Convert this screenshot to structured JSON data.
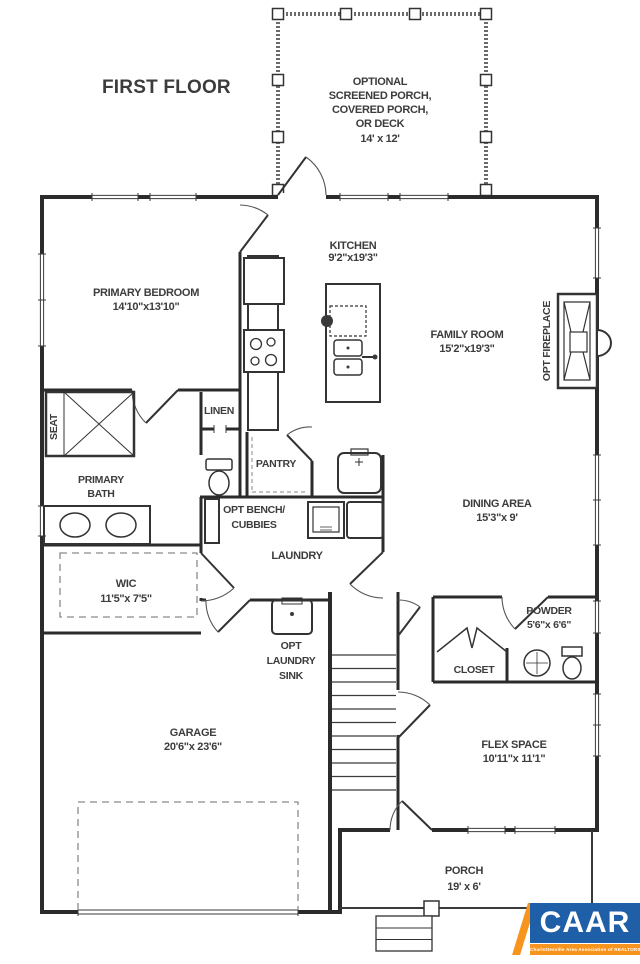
{
  "title": "FIRST FLOOR",
  "rooms": {
    "optional_porch": {
      "line1": "OPTIONAL",
      "line2": "SCREENED PORCH,",
      "line3": "COVERED PORCH,",
      "line4": "OR DECK",
      "dims": "14' x 12'"
    },
    "primary_bedroom": {
      "name": "PRIMARY BEDROOM",
      "dims": "14'10\"x13'10\""
    },
    "kitchen": {
      "name": "KITCHEN",
      "dims": "9'2\"x19'3\""
    },
    "family_room": {
      "name": "FAMILY ROOM",
      "dims": "15'2\"x19'3\""
    },
    "opt_fireplace": {
      "name": "OPT FIREPLACE"
    },
    "seat": {
      "name": "SEAT"
    },
    "linen": {
      "name": "LINEN"
    },
    "primary_bath": {
      "line1": "PRIMARY",
      "line2": "BATH"
    },
    "pantry": {
      "name": "PANTRY"
    },
    "opt_bench": {
      "line1": "OPT BENCH/",
      "line2": "CUBBIES"
    },
    "laundry": {
      "name": "LAUNDRY"
    },
    "dining_area": {
      "name": "DINING AREA",
      "dims": "15'3\"x 9'"
    },
    "wic": {
      "name": "WIC",
      "dims": "11'5\"x 7'5\""
    },
    "opt_laundry_sink": {
      "line1": "OPT",
      "line2": "LAUNDRY",
      "line3": "SINK"
    },
    "powder": {
      "name": "POWDER",
      "dims": "5'6\"x 6'6\""
    },
    "closet": {
      "name": "CLOSET"
    },
    "flex_space": {
      "name": "FLEX SPACE",
      "dims": "10'11\"x 11'1\""
    },
    "garage": {
      "name": "GARAGE",
      "dims": "20'6\"x 23'6\""
    },
    "porch": {
      "name": "PORCH",
      "dims": "19' x 6'"
    }
  },
  "logo": {
    "text": "CAAR",
    "tagline": "Charlottesville Area Association of REALTORS®",
    "blue": "#1e5fa8",
    "orange": "#f7941d"
  },
  "colors": {
    "wall": "#2b2b2b",
    "text": "#3c3c3c",
    "porch_wall": "#6b6b6b",
    "dashed": "#8a8a8a"
  }
}
